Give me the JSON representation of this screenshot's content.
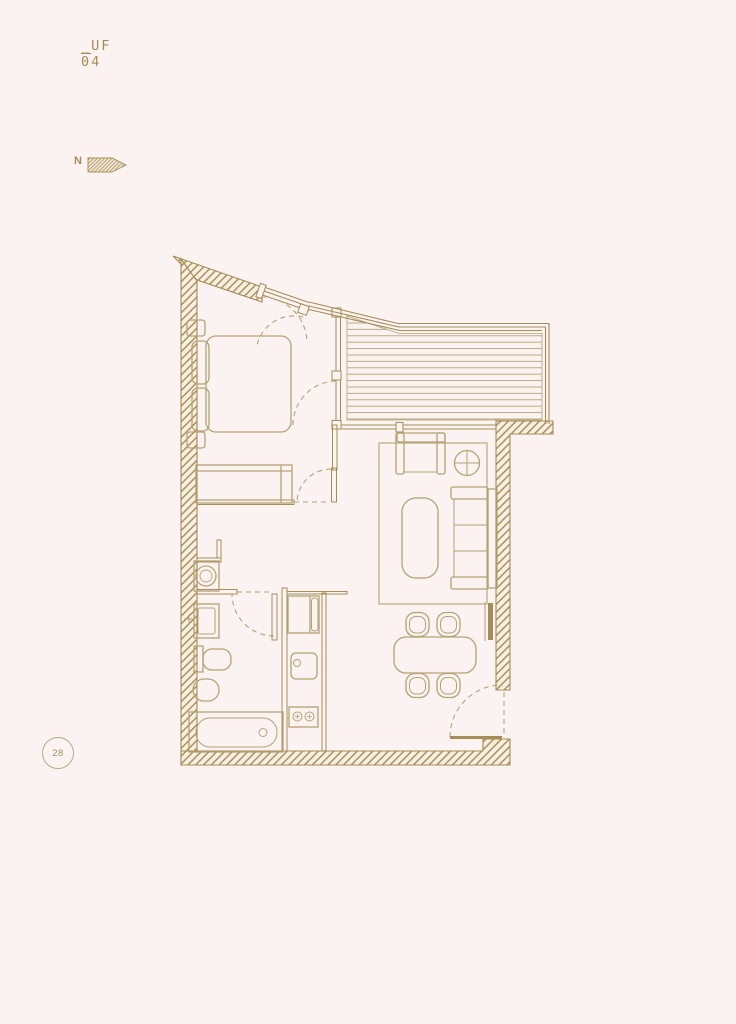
{
  "header": {
    "line1": "_UF",
    "line2_first": "0",
    "line2_rest": "4"
  },
  "compass": {
    "label": "N",
    "icon": "north-arrow-icon"
  },
  "badge": {
    "number": "28"
  },
  "colors": {
    "background": "#faf3f2",
    "wall_line": "#a68c55",
    "furniture_line": "#b7a273",
    "hatch_fill": "#f7efe3",
    "badge_ring": "#bca97e"
  }
}
